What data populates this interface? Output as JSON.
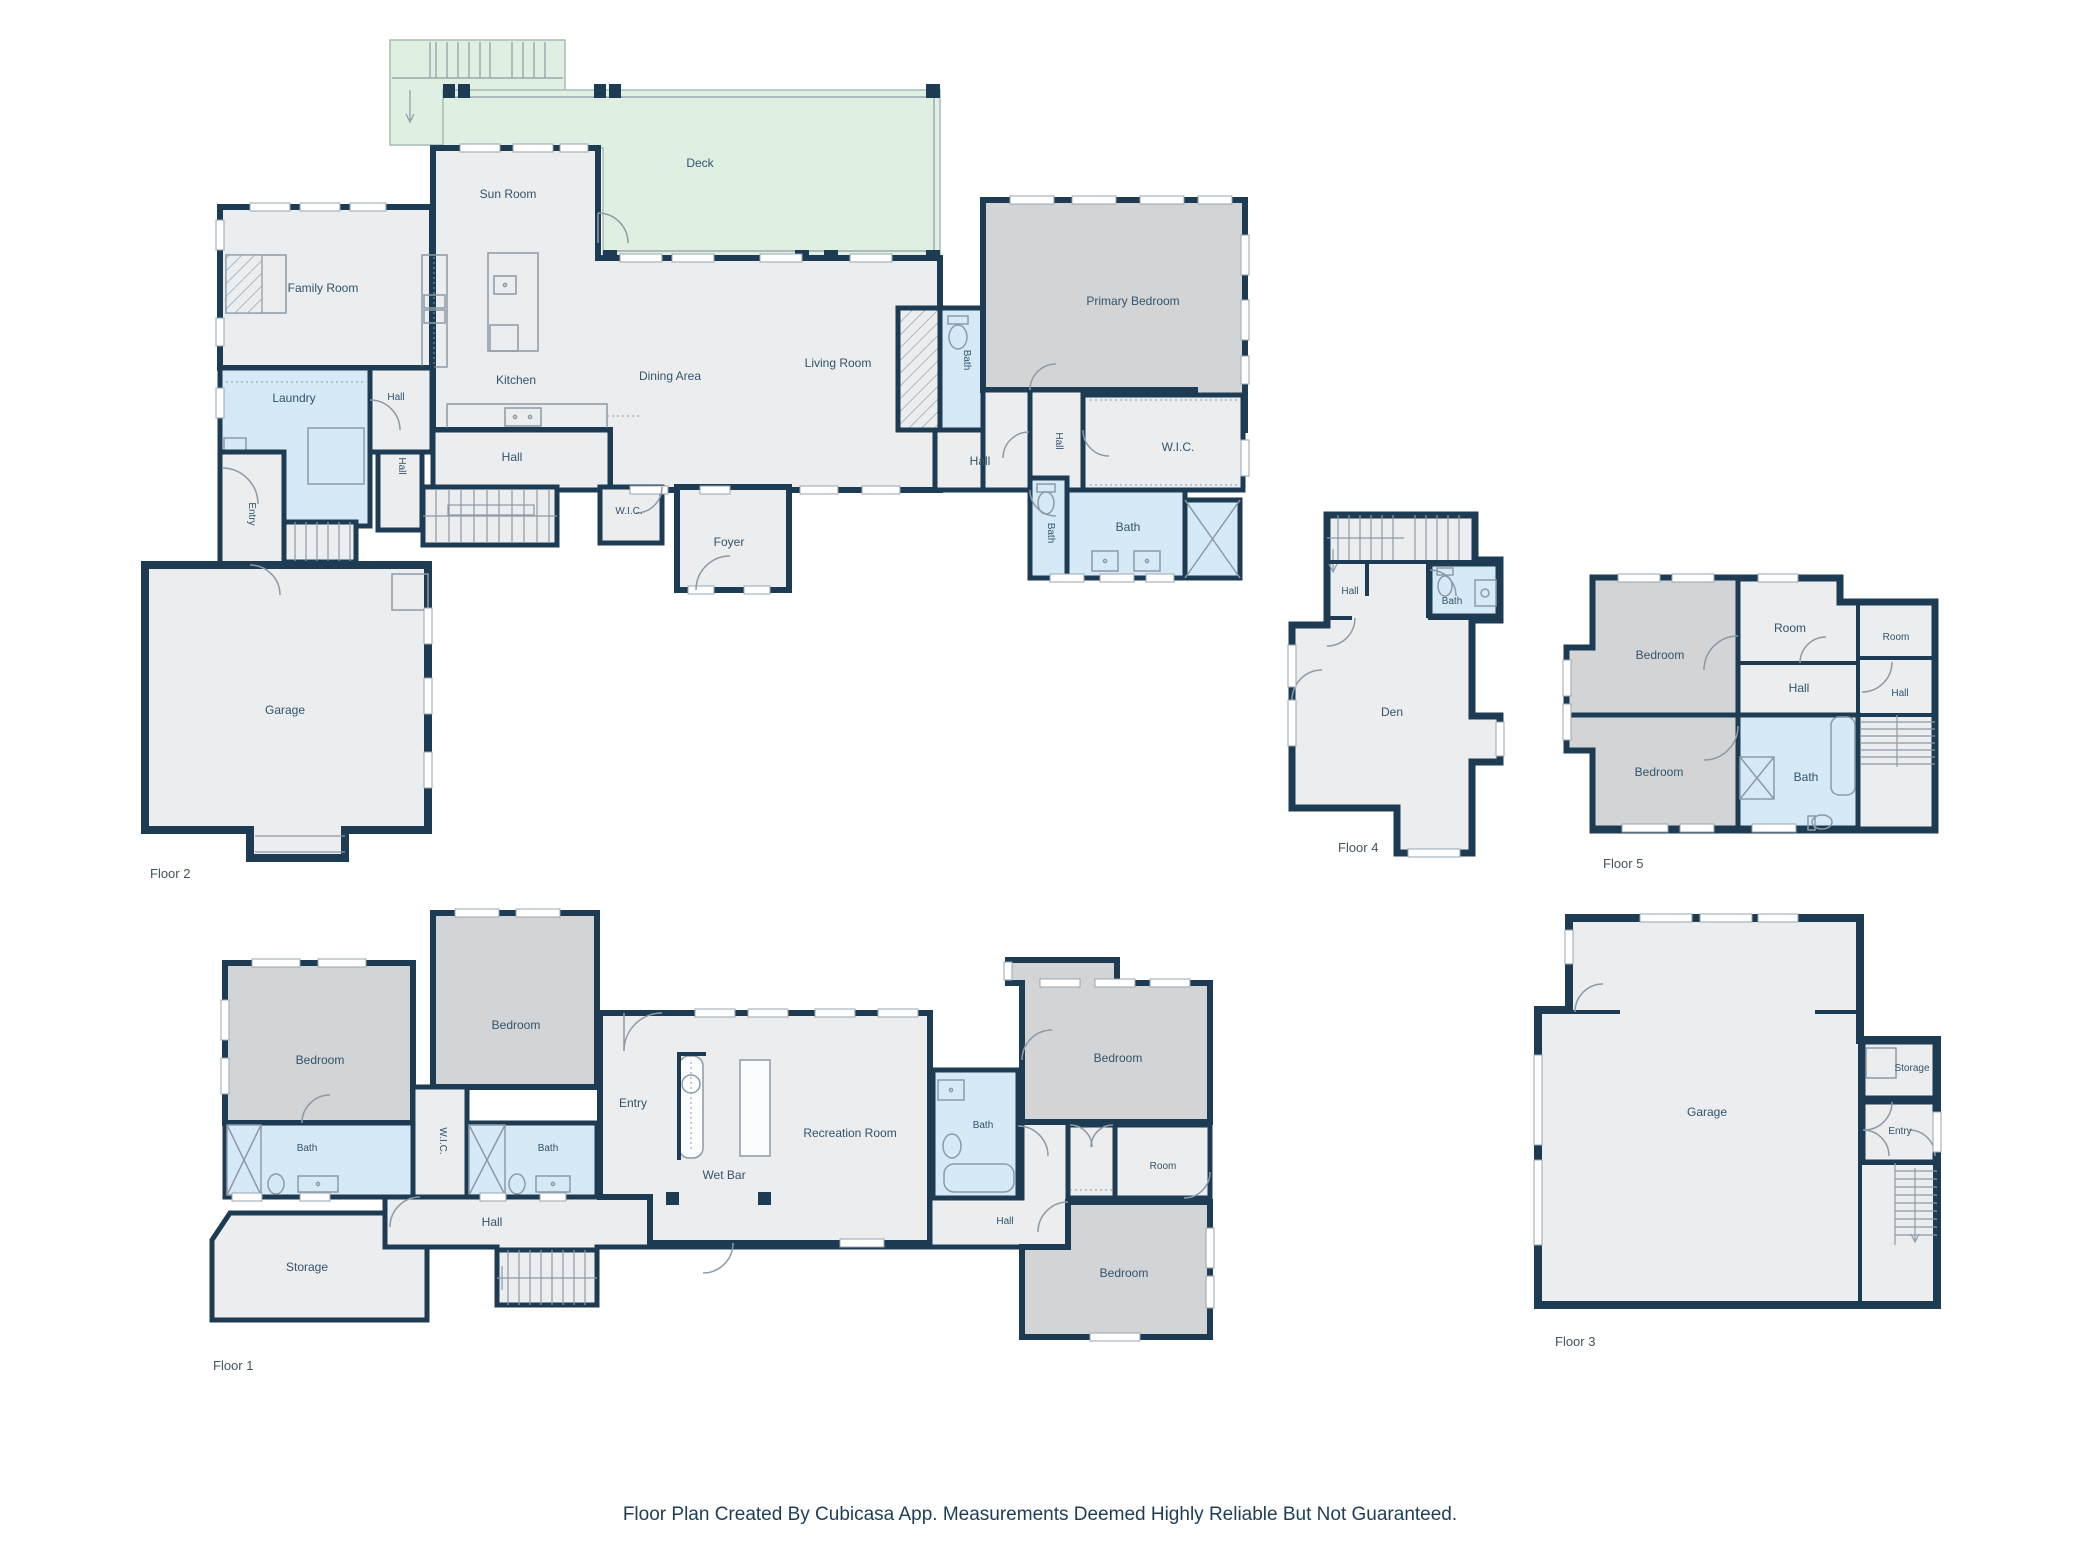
{
  "colors": {
    "wall": "#1d3b52",
    "room_fill": "#ebedef",
    "bedroom_fill": "#d2d4d6",
    "bath_fill": "#d5eaf6",
    "deck_fill": "#dff0e2",
    "label_text": "#33536b"
  },
  "footer": {
    "disclaimer": "Floor Plan Created By Cubicasa App. Measurements Deemed Highly Reliable But Not Guaranteed."
  },
  "floors": {
    "floor2": {
      "label": "Floor 2",
      "rooms": {
        "deck": "Deck",
        "sun_room": "Sun Room",
        "family_room": "Family Room",
        "kitchen": "Kitchen",
        "dining_area": "Dining Area",
        "living_room": "Living Room",
        "primary_bedroom": "Primary Bedroom",
        "laundry": "Laundry",
        "hall_a": "Hall",
        "hall_b": "Hall",
        "hall_c": "Hall",
        "hall_d": "Hall",
        "hall_e": "Hall",
        "entry": "Entry",
        "garage": "Garage",
        "foyer": "Foyer",
        "wic_a": "W.I.C.",
        "wic_b": "W.I.C.",
        "bath_a": "Bath",
        "bath_b": "Bath",
        "bath_c": "Bath"
      }
    },
    "floor4": {
      "label": "Floor 4",
      "rooms": {
        "hall": "Hall",
        "bath": "Bath",
        "den": "Den"
      }
    },
    "floor5": {
      "label": "Floor 5",
      "rooms": {
        "bedroom_a": "Bedroom",
        "bedroom_b": "Bedroom",
        "room_a": "Room",
        "room_b": "Room",
        "hall_a": "Hall",
        "hall_b": "Hall",
        "bath": "Bath"
      }
    },
    "floor1": {
      "label": "Floor 1",
      "rooms": {
        "bedroom_a": "Bedroom",
        "bedroom_b": "Bedroom",
        "bedroom_c": "Bedroom",
        "bedroom_d": "Bedroom",
        "bath_a": "Bath",
        "bath_b": "Bath",
        "bath_c": "Bath",
        "wic": "W.I.C.",
        "entry": "Entry",
        "wet_bar": "Wet Bar",
        "recreation_room": "Recreation Room",
        "room": "Room",
        "hall_a": "Hall",
        "hall_b": "Hall",
        "storage": "Storage"
      }
    },
    "floor3": {
      "label": "Floor 3",
      "rooms": {
        "garage": "Garage",
        "storage": "Storage",
        "entry": "Entry"
      }
    }
  }
}
